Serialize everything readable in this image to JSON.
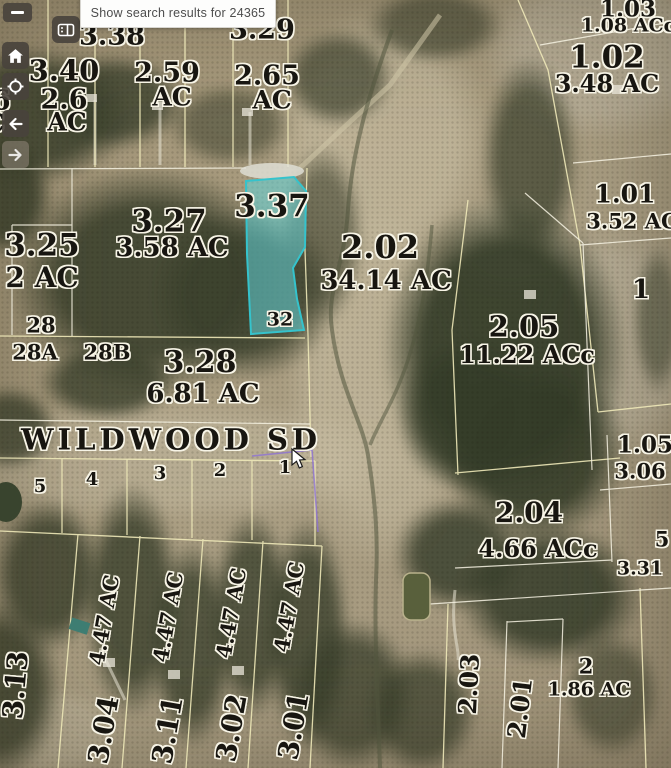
{
  "tooltip": {
    "text": "Show search results for 24365"
  },
  "toolbar": {
    "zoom_out": "–",
    "buttons": [
      "zoom-out",
      "home",
      "locate",
      "back",
      "forward"
    ]
  },
  "map": {
    "road": "WILDWOOD SD",
    "highlight_color": "#35c3cc",
    "selected_parcel": {
      "id": "3.37",
      "lot": "32"
    },
    "lots": [
      "5",
      "4",
      "3",
      "2",
      "1"
    ],
    "parcels": [
      {
        "id": "3.38"
      },
      {
        "id": "3.29"
      },
      {
        "id": "3.40"
      },
      {
        "id": "2.59",
        "ac": "AC"
      },
      {
        "id": "2.65",
        "ac": "AC"
      },
      {
        "id": "2.6",
        "ac": "AC"
      },
      {
        "id": "1.03",
        "ac": "1.08 ACc"
      },
      {
        "id": "1.02",
        "ac": "3.48 AC"
      },
      {
        "id": "3.27",
        "ac": "3.58 AC"
      },
      {
        "id": "2.02",
        "ac": "34.14 AC"
      },
      {
        "id": "3.25",
        "ac": "2 AC"
      },
      {
        "id": "1.01",
        "ac": "3.52 AC"
      },
      {
        "id": "28"
      },
      {
        "id": "28A"
      },
      {
        "id": "28B"
      },
      {
        "id": "3.28",
        "ac": "6.81 AC"
      },
      {
        "id": "2.05",
        "ac": "11.22 ACc"
      },
      {
        "id": "1"
      },
      {
        "id": "1.05",
        "ac": "3.06"
      },
      {
        "id": "2.04",
        "ac": "4.66 ACc"
      },
      {
        "id": "5",
        "ac": "3.31"
      },
      {
        "id": "3.13"
      },
      {
        "id": "3.04",
        "ac": "4.47 AC"
      },
      {
        "id": "3.11",
        "ac": "4.47 AC"
      },
      {
        "id": "3.02",
        "ac": "4.47 AC"
      },
      {
        "id": "3.01",
        "ac": "4.47 AC"
      },
      {
        "id": "2.03"
      },
      {
        "id": "2.01"
      },
      {
        "id": "2",
        "ac": "1.86 AC"
      }
    ]
  }
}
